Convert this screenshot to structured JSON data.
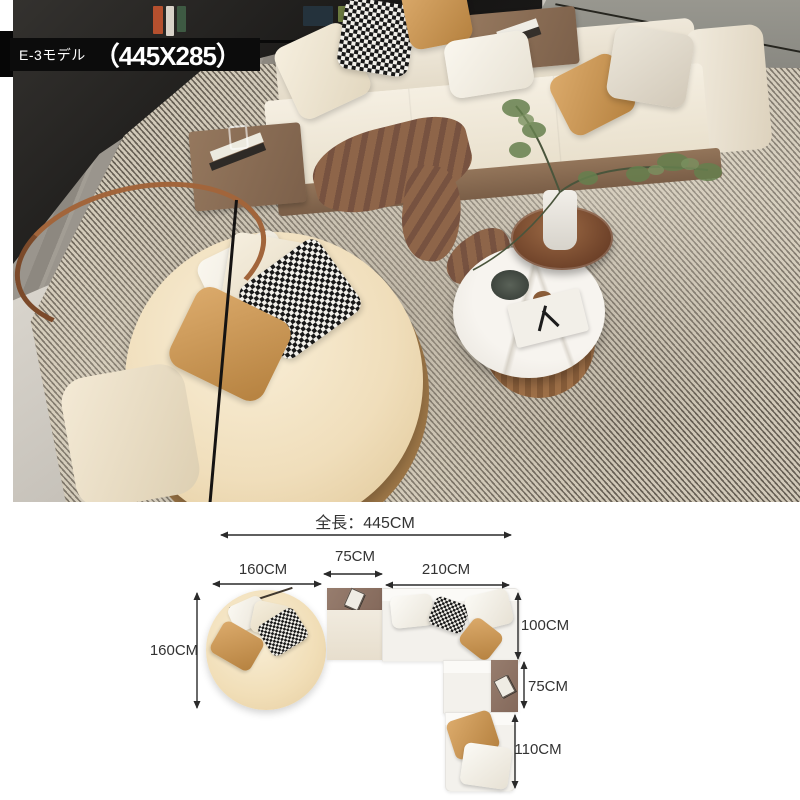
{
  "banner": {
    "model": "E-3モデル",
    "dimensions": "（445X285）"
  },
  "diagram": {
    "total_length": "全長：445CM",
    "top_widths": {
      "left": "160CM",
      "middle": "75CM",
      "right": "210CM"
    },
    "left_depth": "160CM",
    "right_segments": {
      "top": "100CM",
      "middle": "75CM",
      "bottom": "110CM"
    }
  },
  "colors": {
    "banner_bg": "#0c0c0c",
    "banner_text": "#ffffff",
    "dimension_text": "#333333",
    "arrow": "#2a2a2a",
    "sofa_cream": "#f0e8d9",
    "chaise_cream": "#f1deb7",
    "table_brown": "#8e7465",
    "pillow_tan": "#cd9a61",
    "rug_grey": "#b3aa9a",
    "floor_grey": "#8f8a84"
  }
}
